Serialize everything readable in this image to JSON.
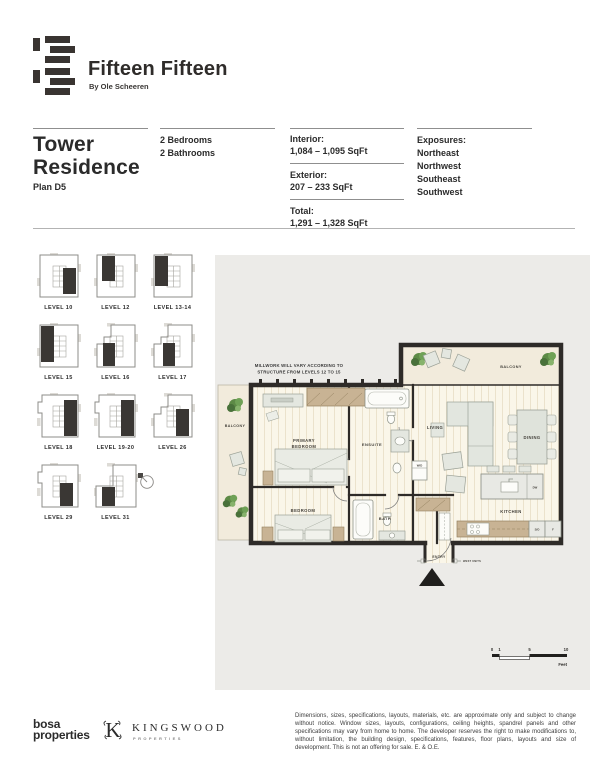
{
  "brand": {
    "title": "Fifteen Fifteen",
    "subtitle": "By Ole Scheeren"
  },
  "header": {
    "title_line1": "Tower",
    "title_line2": "Residence",
    "plan": "Plan D5",
    "bedrooms": "2 Bedrooms",
    "bathrooms": "2 Bathrooms",
    "areas": [
      {
        "label": "Interior:",
        "value": "1,084 – 1,095 SqFt"
      },
      {
        "label": "Exterior:",
        "value": "207 – 233 SqFt"
      },
      {
        "label": "Total:",
        "value": "1,291 – 1,328 SqFt"
      }
    ],
    "exposures_label": "Exposures:",
    "exposures": [
      "Northeast",
      "Northwest",
      "Southeast",
      "Southwest"
    ]
  },
  "levels": {
    "items": [
      {
        "label": "LEVEL 10",
        "shape": "full",
        "unit": {
          "x": 27,
          "y": 16,
          "w": 13,
          "h": 26
        }
      },
      {
        "label": "LEVEL 12",
        "shape": "full",
        "unit": {
          "x": 9,
          "y": 4,
          "w": 13,
          "h": 25
        }
      },
      {
        "label": "LEVEL 13-14",
        "shape": "full",
        "unit": {
          "x": 5,
          "y": 4,
          "w": 13,
          "h": 30
        }
      },
      {
        "label": "LEVEL 15",
        "shape": "full",
        "unit": {
          "x": 5,
          "y": 4,
          "w": 13,
          "h": 36
        }
      },
      {
        "label": "LEVEL 16",
        "shape": "notch",
        "unit": {
          "x": 10,
          "y": 21,
          "w": 12,
          "h": 23
        }
      },
      {
        "label": "LEVEL 17",
        "shape": "notch",
        "unit": {
          "x": 13,
          "y": 21,
          "w": 12,
          "h": 23
        }
      },
      {
        "label": "LEVEL 18",
        "shape": "tab",
        "unit": {
          "x": 28,
          "y": 8,
          "w": 13,
          "h": 36
        }
      },
      {
        "label": "LEVEL 19-20",
        "shape": "tab",
        "unit": {
          "x": 28,
          "y": 8,
          "w": 13,
          "h": 36
        }
      },
      {
        "label": "LEVEL 26",
        "shape": "notch",
        "unit": {
          "x": 26,
          "y": 17,
          "w": 13,
          "h": 27
        }
      },
      {
        "label": "LEVEL 29",
        "shape": "tab",
        "unit": {
          "x": 24,
          "y": 21,
          "w": 13,
          "h": 23
        }
      },
      {
        "label": "LEVEL 31",
        "shape": "notchwide",
        "unit": {
          "x": 9,
          "y": 25,
          "w": 13,
          "h": 19
        }
      }
    ]
  },
  "plan": {
    "note_line1": "MILLWORK WILL VARY ACCORDING TO",
    "note_line2": "STRUCTURE FROM LEVELS 12 TO 15",
    "rooms": {
      "balcony_left": "BALCONY",
      "balcony_top": "BALCONY",
      "primary_line1": "PRIMARY",
      "primary_line2": "BEDROOM",
      "ensuite": "ENSUITE",
      "living": "LIVING",
      "dining": "DINING",
      "bedroom": "BEDROOM",
      "bath": "BATH",
      "kitchen": "KITCHEN",
      "entry": "ENTRY"
    },
    "tags": {
      "wd": "W/D",
      "dw": "DW",
      "so": "S/O",
      "f": "F",
      "west_units": "WEST UNITS"
    },
    "scale": {
      "t0": "0",
      "t1": "1",
      "t5": "5",
      "t10": "10",
      "unit": "Feet"
    }
  },
  "footer": {
    "bosa_line1": "bosa",
    "bosa_line2": "properties",
    "kingswood": "KINGSWOOD",
    "kingswood_sub": "PROPERTIES",
    "disclaimer": "Dimensions, sizes, specifications, layouts, materials, etc. are approximate only and subject to change without notice. Window sizes, layouts, configurations, ceiling heights, spandrel panels and other specifications may vary from home to home. The developer reserves the right to make modifications to, without limitation, the building design, specifications, features, floor plans, layouts and size of development. This is not an offering for sale. E. & O.E."
  }
}
